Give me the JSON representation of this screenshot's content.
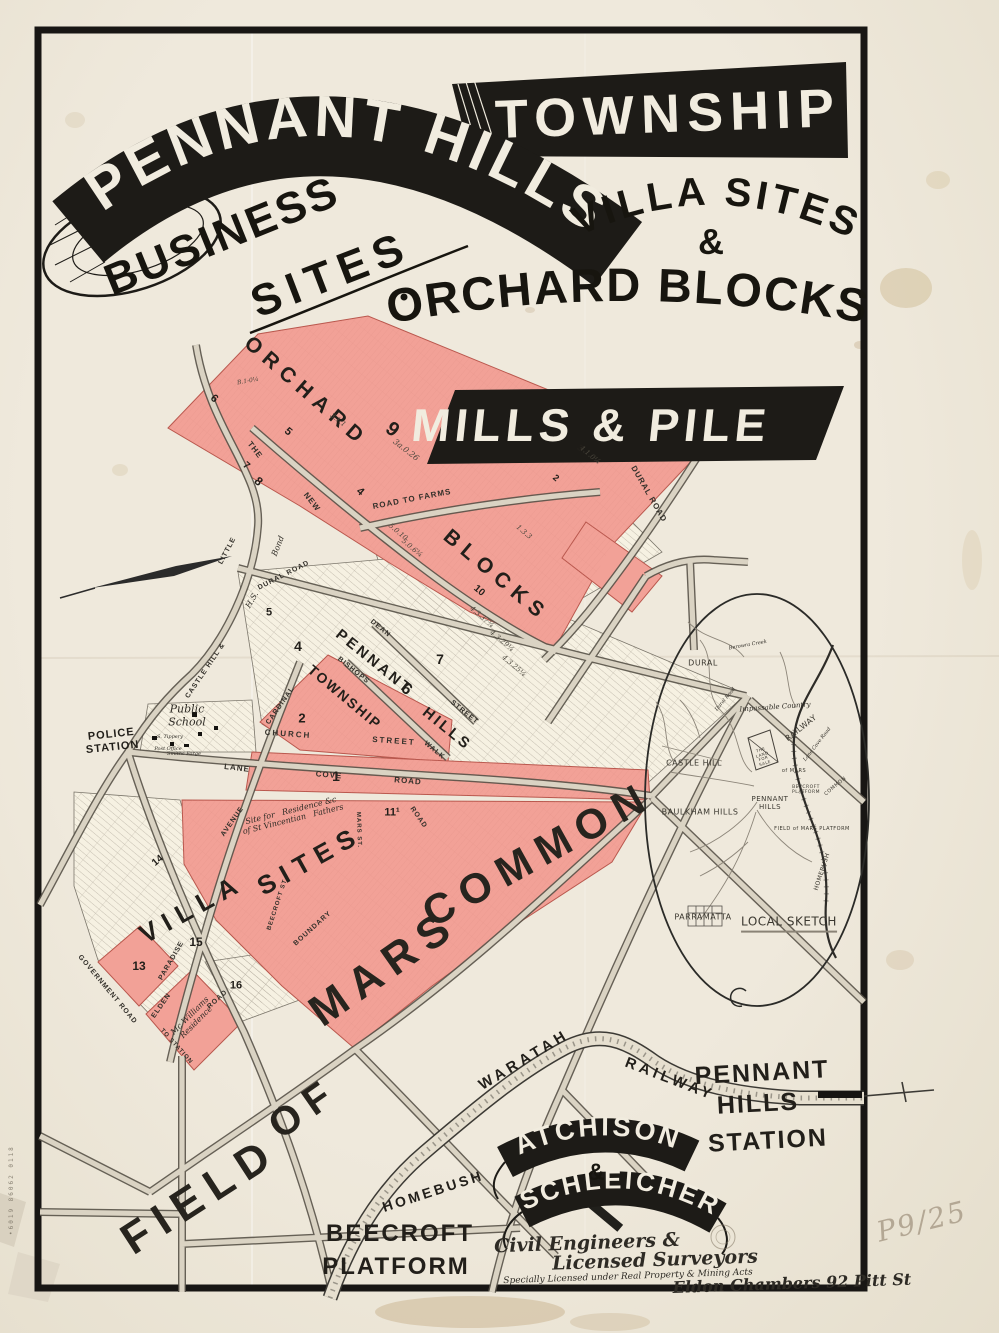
{
  "header": {
    "ribbon": "PENNANT HILLS",
    "township": "TOWNSHIP",
    "villa_sites": "VILLA SITES",
    "ampersand": "&",
    "orchard_blocks": "ORCHARD BLOCKS",
    "business": "BUSINESS",
    "sites": "SITES"
  },
  "agency": {
    "name": "MILLS & PILE"
  },
  "surveyors": {
    "name1": "ATCHISON",
    "amp": "&",
    "name2": "SCHLEICHER"
  },
  "annotations": {
    "pencil_mark": "P9/25",
    "edge_stamp": "•6019 86062 0118"
  },
  "palette": {
    "paper": "#ece6d7",
    "ink": "#1d1b17",
    "pink": "#f2a197",
    "road": "#dad3c3"
  },
  "map": {
    "labels": [
      {
        "t": "ORCHARD",
        "x": 306,
        "y": 392,
        "r": 41,
        "s": 21,
        "c": "cap",
        "sp": 7,
        "n": "orchard-area-label"
      },
      {
        "t": "BLOCKS",
        "x": 496,
        "y": 576,
        "r": 40,
        "s": 21,
        "c": "cap",
        "sp": 7,
        "n": "blocks-area-label"
      },
      {
        "t": "PENNANT",
        "x": 374,
        "y": 662,
        "r": 39,
        "s": 15,
        "c": "cap",
        "sp": 3
      },
      {
        "t": "6",
        "x": 406,
        "y": 690,
        "r": 39,
        "s": 16,
        "c": "cap"
      },
      {
        "t": "HILLS",
        "x": 447,
        "y": 729,
        "r": 39,
        "s": 15,
        "c": "cap",
        "sp": 3
      },
      {
        "t": "TOWNSHIP",
        "x": 345,
        "y": 697,
        "r": 40,
        "s": 14,
        "c": "cap",
        "sp": 2
      },
      {
        "t": "2",
        "x": 302,
        "y": 719,
        "s": 13,
        "c": "cap"
      },
      {
        "t": "4",
        "x": 298,
        "y": 646,
        "s": 14,
        "c": "cap"
      },
      {
        "t": "5",
        "x": 269,
        "y": 613,
        "s": 11,
        "c": "cap"
      },
      {
        "t": "7",
        "x": 440,
        "y": 659,
        "s": 14,
        "c": "cap"
      },
      {
        "t": "10",
        "x": 479,
        "y": 591,
        "r": 40,
        "s": 10,
        "c": "cap"
      },
      {
        "t": "1",
        "x": 336,
        "y": 776,
        "s": 14,
        "c": "cap"
      },
      {
        "t": "11¹",
        "x": 392,
        "y": 813,
        "s": 11,
        "c": "cap"
      },
      {
        "t": "13",
        "x": 139,
        "y": 967,
        "s": 12,
        "c": "cap"
      },
      {
        "t": "15",
        "x": 196,
        "y": 943,
        "s": 12,
        "c": "cap"
      },
      {
        "t": "16",
        "x": 236,
        "y": 986,
        "s": 11,
        "c": "cap"
      },
      {
        "t": "14",
        "x": 158,
        "y": 861,
        "r": -40,
        "s": 10,
        "c": "cap"
      },
      {
        "t": "8",
        "x": 258,
        "y": 482,
        "r": 41,
        "s": 12,
        "c": "cap"
      },
      {
        "t": "9",
        "x": 392,
        "y": 430,
        "r": 38,
        "s": 20,
        "c": "cap"
      },
      {
        "t": "3a.0.26",
        "x": 406,
        "y": 450,
        "r": 38,
        "s": 8,
        "c": "lot"
      },
      {
        "t": "3.1.1",
        "x": 338,
        "y": 420,
        "r": 38,
        "s": 7,
        "c": "lot"
      },
      {
        "t": "4.1.0¼",
        "x": 590,
        "y": 455,
        "r": 40,
        "s": 7,
        "c": "lot"
      },
      {
        "t": "1.3.3",
        "x": 524,
        "y": 532,
        "r": 40,
        "s": 7,
        "c": "lot"
      },
      {
        "t": "5.0.10",
        "x": 398,
        "y": 532,
        "r": 40,
        "s": 7,
        "c": "lot"
      },
      {
        "t": "4.3.37¾",
        "x": 482,
        "y": 617,
        "r": 40,
        "s": 7,
        "c": "lot"
      },
      {
        "t": "4.3.29¼",
        "x": 502,
        "y": 641,
        "r": 40,
        "s": 7,
        "c": "lot"
      },
      {
        "t": "4.3.25¼",
        "x": 514,
        "y": 666,
        "r": 40,
        "s": 7,
        "c": "lot"
      },
      {
        "t": "5.0.6¾",
        "x": 412,
        "y": 548,
        "r": 40,
        "s": 7,
        "c": "lot"
      },
      {
        "t": "6",
        "x": 214,
        "y": 399,
        "r": 41,
        "s": 11,
        "c": "cap"
      },
      {
        "t": "5",
        "x": 288,
        "y": 432,
        "r": 41,
        "s": 11,
        "c": "cap"
      },
      {
        "t": "4",
        "x": 360,
        "y": 492,
        "r": 41,
        "s": 11,
        "c": "cap"
      },
      {
        "t": "7",
        "x": 246,
        "y": 466,
        "r": 41,
        "s": 10,
        "c": "cap"
      },
      {
        "t": "3",
        "x": 580,
        "y": 448,
        "r": 40,
        "s": 9,
        "c": "cap"
      },
      {
        "t": "2",
        "x": 556,
        "y": 478,
        "r": 40,
        "s": 9,
        "c": "cap"
      },
      {
        "t": "B.1-0¼",
        "x": 248,
        "y": 382,
        "r": -10,
        "s": 6,
        "c": "lot"
      },
      {
        "t": "THE",
        "x": 255,
        "y": 450,
        "r": 52,
        "s": 8,
        "c": "street"
      },
      {
        "t": "NEW",
        "x": 312,
        "y": 502,
        "r": 52,
        "s": 8,
        "c": "street"
      },
      {
        "t": "ROAD TO FARMS",
        "x": 412,
        "y": 499,
        "r": -11,
        "s": 8,
        "c": "street"
      },
      {
        "t": "DURAL ROAD",
        "x": 649,
        "y": 494,
        "r": 60,
        "s": 8,
        "c": "street"
      },
      {
        "t": "LITTLE",
        "x": 228,
        "y": 551,
        "r": -62,
        "s": 7,
        "c": "street"
      },
      {
        "t": "DURAL ROAD",
        "x": 284,
        "y": 576,
        "r": -27,
        "s": 7,
        "c": "street"
      },
      {
        "t": "CASTLE HILL &",
        "x": 206,
        "y": 671,
        "r": -56,
        "s": 7,
        "c": "street"
      },
      {
        "t": "H.S.",
        "x": 252,
        "y": 600,
        "r": -60,
        "s": 8,
        "c": "hand"
      },
      {
        "t": "Bond",
        "x": 278,
        "y": 546,
        "r": -68,
        "s": 8,
        "c": "hand"
      },
      {
        "t": "CARDINAL",
        "x": 281,
        "y": 706,
        "r": -55,
        "s": 7,
        "c": "street"
      },
      {
        "t": "AVENUE",
        "x": 233,
        "y": 822,
        "r": -55,
        "s": 7,
        "c": "street"
      },
      {
        "t": "DEAN",
        "x": 380,
        "y": 629,
        "r": 39,
        "s": 7,
        "c": "street"
      },
      {
        "t": "STREET",
        "x": 464,
        "y": 713,
        "r": 39,
        "s": 7,
        "c": "street"
      },
      {
        "t": "BISHOPS",
        "x": 353,
        "y": 671,
        "r": 39,
        "s": 7,
        "c": "street"
      },
      {
        "t": "WALK",
        "x": 434,
        "y": 751,
        "r": 39,
        "s": 7,
        "c": "street"
      },
      {
        "t": "CHURCH",
        "x": 288,
        "y": 734,
        "r": 4,
        "s": 8,
        "c": "street",
        "sp": 2
      },
      {
        "t": "STREET",
        "x": 394,
        "y": 741,
        "r": 4,
        "s": 8,
        "c": "street",
        "sp": 2
      },
      {
        "t": "LANE",
        "x": 237,
        "y": 768,
        "r": 7,
        "s": 8,
        "c": "street"
      },
      {
        "t": "COVE",
        "x": 329,
        "y": 775,
        "r": 5,
        "s": 8,
        "c": "street"
      },
      {
        "t": "ROAD",
        "x": 408,
        "y": 781,
        "r": 5,
        "s": 8,
        "c": "street"
      },
      {
        "t": "ROAD",
        "x": 418,
        "y": 818,
        "r": 55,
        "s": 7,
        "c": "street"
      },
      {
        "t": "MARS ST.",
        "x": 358,
        "y": 830,
        "r": 88,
        "s": 6,
        "c": "street"
      },
      {
        "t": "BOUNDARY",
        "x": 313,
        "y": 929,
        "r": -42,
        "s": 7,
        "c": "street"
      },
      {
        "t": "BEECROFT ST",
        "x": 278,
        "y": 905,
        "r": -72,
        "s": 6,
        "c": "street"
      },
      {
        "t": "PARADISE",
        "x": 172,
        "y": 961,
        "r": -60,
        "s": 7,
        "c": "street"
      },
      {
        "t": "ELDEN",
        "x": 162,
        "y": 1006,
        "r": -55,
        "s": 7,
        "c": "street"
      },
      {
        "t": "ROAD",
        "x": 218,
        "y": 1000,
        "r": -42,
        "s": 7,
        "c": "street"
      },
      {
        "t": "GOVERNMENT ROAD",
        "x": 107,
        "y": 990,
        "r": 50,
        "s": 7,
        "c": "street"
      },
      {
        "t": "TO STATION",
        "x": 176,
        "y": 1047,
        "r": 48,
        "s": 6,
        "c": "street"
      },
      {
        "t": "Mc Williams\nResidence",
        "x": 193,
        "y": 1019,
        "r": -45,
        "s": 8,
        "c": "hand"
      },
      {
        "t": "Site for   Residence &c\nof St Vincentian   Fathers",
        "x": 292,
        "y": 815,
        "r": -14,
        "s": 8,
        "c": "hand"
      },
      {
        "t": "POLICE\nSTATION",
        "x": 112,
        "y": 741,
        "r": -6,
        "s": 11,
        "c": "cap",
        "sp": 1,
        "n": "police-station-label"
      },
      {
        "t": "Public\nSchool",
        "x": 187,
        "y": 716,
        "s": 11,
        "c": "hand",
        "n": "public-school-label"
      },
      {
        "t": "Post Office",
        "x": 168,
        "y": 750,
        "s": 5,
        "c": "hand"
      },
      {
        "t": "Smiths Forge",
        "x": 184,
        "y": 755,
        "s": 5,
        "c": "hand"
      },
      {
        "t": "S. Tippery",
        "x": 170,
        "y": 738,
        "s": 5,
        "c": "hand"
      },
      {
        "t": "VILLA",
        "x": 192,
        "y": 909,
        "r": -29,
        "s": 26,
        "c": "cap",
        "sp": 8,
        "n": "villa-sites-label"
      },
      {
        "t": "SITES",
        "x": 310,
        "y": 861,
        "r": -29,
        "s": 26,
        "c": "cap",
        "sp": 8
      },
      {
        "t": "FIELD",
        "x": 200,
        "y": 1196,
        "r": -33,
        "s": 44,
        "c": "big",
        "n": "field-of-mars-common-label"
      },
      {
        "t": "OF",
        "x": 304,
        "y": 1108,
        "r": -35,
        "s": 40,
        "c": "big"
      },
      {
        "t": "MARS",
        "x": 384,
        "y": 968,
        "r": -35,
        "s": 44,
        "c": "big"
      },
      {
        "t": "COMMON",
        "x": 538,
        "y": 854,
        "r": -29,
        "s": 42,
        "c": "big"
      },
      {
        "t": "WARATAH",
        "x": 524,
        "y": 1060,
        "r": -31,
        "s": 15,
        "c": "cap",
        "sp": 4
      },
      {
        "t": "RAILWAY",
        "x": 670,
        "y": 1079,
        "r": 21,
        "s": 15,
        "c": "cap",
        "sp": 4
      },
      {
        "t": "HOMEBUSH",
        "x": 433,
        "y": 1191,
        "r": -18,
        "s": 14,
        "c": "cap",
        "sp": 3
      },
      {
        "t": "PENNANT",
        "x": 762,
        "y": 1073,
        "r": -3,
        "s": 25,
        "c": "cap",
        "sp": 2,
        "n": "pennant-hills-station-label"
      },
      {
        "t": "HILLS",
        "x": 758,
        "y": 1104,
        "r": -3,
        "s": 25,
        "c": "cap",
        "sp": 2
      },
      {
        "t": "STATION",
        "x": 768,
        "y": 1141,
        "r": -3,
        "s": 25,
        "c": "cap",
        "sp": 2
      },
      {
        "t": "BEECROFT",
        "x": 400,
        "y": 1234,
        "s": 24,
        "c": "cap",
        "sp": 2,
        "n": "beecroft-platform-label"
      },
      {
        "t": "PLATFORM",
        "x": 396,
        "y": 1267,
        "s": 24,
        "c": "cap",
        "sp": 2
      },
      {
        "t": "DURAL",
        "x": 703,
        "y": 663,
        "s": 8,
        "c": "sketch"
      },
      {
        "t": "Impassable Country",
        "x": 775,
        "y": 707,
        "r": -4,
        "s": 7,
        "c": "hand"
      },
      {
        "t": "RAILWAY",
        "x": 801,
        "y": 728,
        "r": -38,
        "s": 8,
        "c": "sketch"
      },
      {
        "t": "Lane Cove Road",
        "x": 818,
        "y": 745,
        "r": -52,
        "s": 5,
        "c": "hand"
      },
      {
        "t": "CASTLE HILL",
        "x": 694,
        "y": 763,
        "s": 8,
        "c": "sketch"
      },
      {
        "t": "BAULKHAM HILLS",
        "x": 700,
        "y": 812,
        "s": 8,
        "c": "sketch"
      },
      {
        "t": "PENNANT\nHILLS",
        "x": 770,
        "y": 803,
        "s": 7,
        "c": "sketch"
      },
      {
        "t": "THE\nLAND\nFOR\nSALE",
        "x": 763,
        "y": 757,
        "r": -18,
        "s": 4,
        "c": "sketch"
      },
      {
        "t": "PARRAMATTA",
        "x": 703,
        "y": 917,
        "s": 8,
        "c": "sketch"
      },
      {
        "t": "LOCAL SKETCH",
        "x": 789,
        "y": 924,
        "s": 12,
        "c": "sketch und",
        "n": "local-sketch-label"
      },
      {
        "t": "Berowra Creek",
        "x": 748,
        "y": 646,
        "r": -10,
        "s": 5,
        "c": "hand"
      },
      {
        "t": "of MARS",
        "x": 794,
        "y": 772,
        "s": 5,
        "c": "sketch"
      },
      {
        "t": "COMMON",
        "x": 836,
        "y": 787,
        "r": -40,
        "s": 5,
        "c": "sketch"
      },
      {
        "t": "BEECROFT\nPLATFORM",
        "x": 806,
        "y": 790,
        "s": 4.5,
        "c": "sketch"
      },
      {
        "t": "FIELD of MARS PLATFORM",
        "x": 812,
        "y": 830,
        "s": 5,
        "c": "sketch"
      },
      {
        "t": "HOMEBUSH",
        "x": 823,
        "y": 872,
        "r": -72,
        "s": 6,
        "c": "sketch"
      },
      {
        "t": "Dural Road",
        "x": 726,
        "y": 700,
        "r": -50,
        "s": 5,
        "c": "hand"
      },
      {
        "t": "Civil Engineers &",
        "x": 587,
        "y": 1244,
        "r": -2,
        "s": 19,
        "c": "hand",
        "w": "bold",
        "n": "surveyor-title-line1"
      },
      {
        "t": "Licensed Surveyors",
        "x": 655,
        "y": 1261,
        "r": -2,
        "s": 19,
        "c": "hand",
        "w": "bold",
        "n": "surveyor-title-line2"
      },
      {
        "t": "Specially Licensed under Real Property & Mining Acts",
        "x": 628,
        "y": 1277,
        "r": -2,
        "s": 9,
        "c": "hand",
        "n": "surveyor-license-line"
      },
      {
        "t": "Eldon Chambers 92 Pitt St",
        "x": 792,
        "y": 1284,
        "r": -2,
        "s": 16,
        "c": "hand",
        "w": "bold",
        "n": "address-label"
      }
    ]
  }
}
